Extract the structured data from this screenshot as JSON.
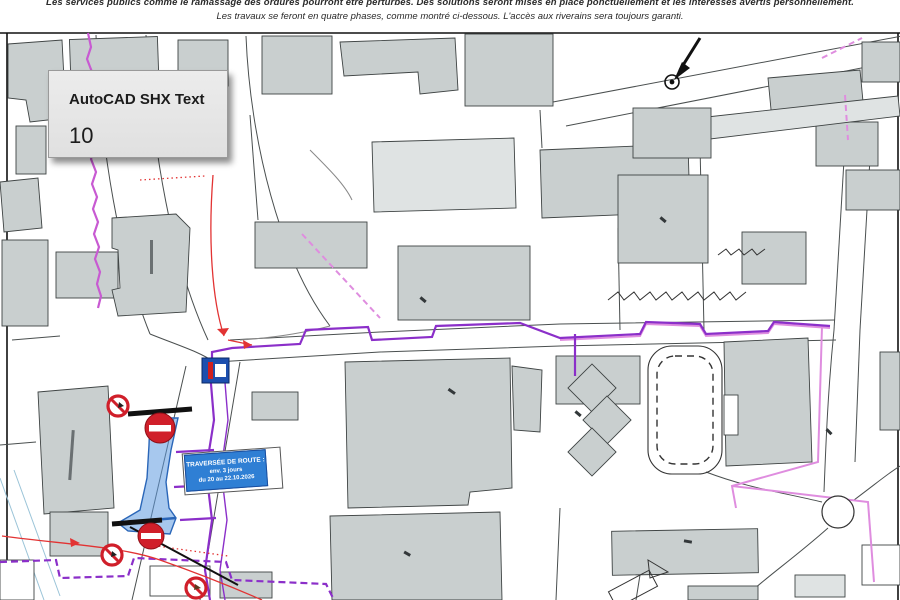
{
  "header": {
    "line1": "Les services publics comme le ramassage des ordures pourront être perturbés. Des solutions seront mises en place ponctuellement et les intéressés avertis personnellement.",
    "line2": "Les travaux se feront en quatre phases, comme montré ci-dessous. L'accès aux riverains sera toujours garanti."
  },
  "popup": {
    "title": "AutoCAD SHX Text",
    "value": "10"
  },
  "work_label": {
    "line1": "TRAVERSÉE DE ROUTE :",
    "line2": "env. 3 jours",
    "line3": "du 20 au 22.10.2026"
  },
  "icons": {
    "no_entry": "no-entry-sign",
    "no_stopping": "no-stopping-sign",
    "closure_flag": "road-closed-flag",
    "detour_arrow": "detour-route-arrow",
    "north_pointer": "survey-point-arrow",
    "roundabout": "roundabout"
  },
  "colors": {
    "building_fill": "#c9cfcf",
    "building_light": "#dfe3e3",
    "utility_purple": "#8b2fc9",
    "utility_pink": "#df8ddf",
    "detour_red": "#e23333",
    "work_zone_blue": "#7fb3e8",
    "sign_red": "#d01f2a",
    "label_blue": "#2f7fd4",
    "popup_gray": "#e8e8e8"
  }
}
